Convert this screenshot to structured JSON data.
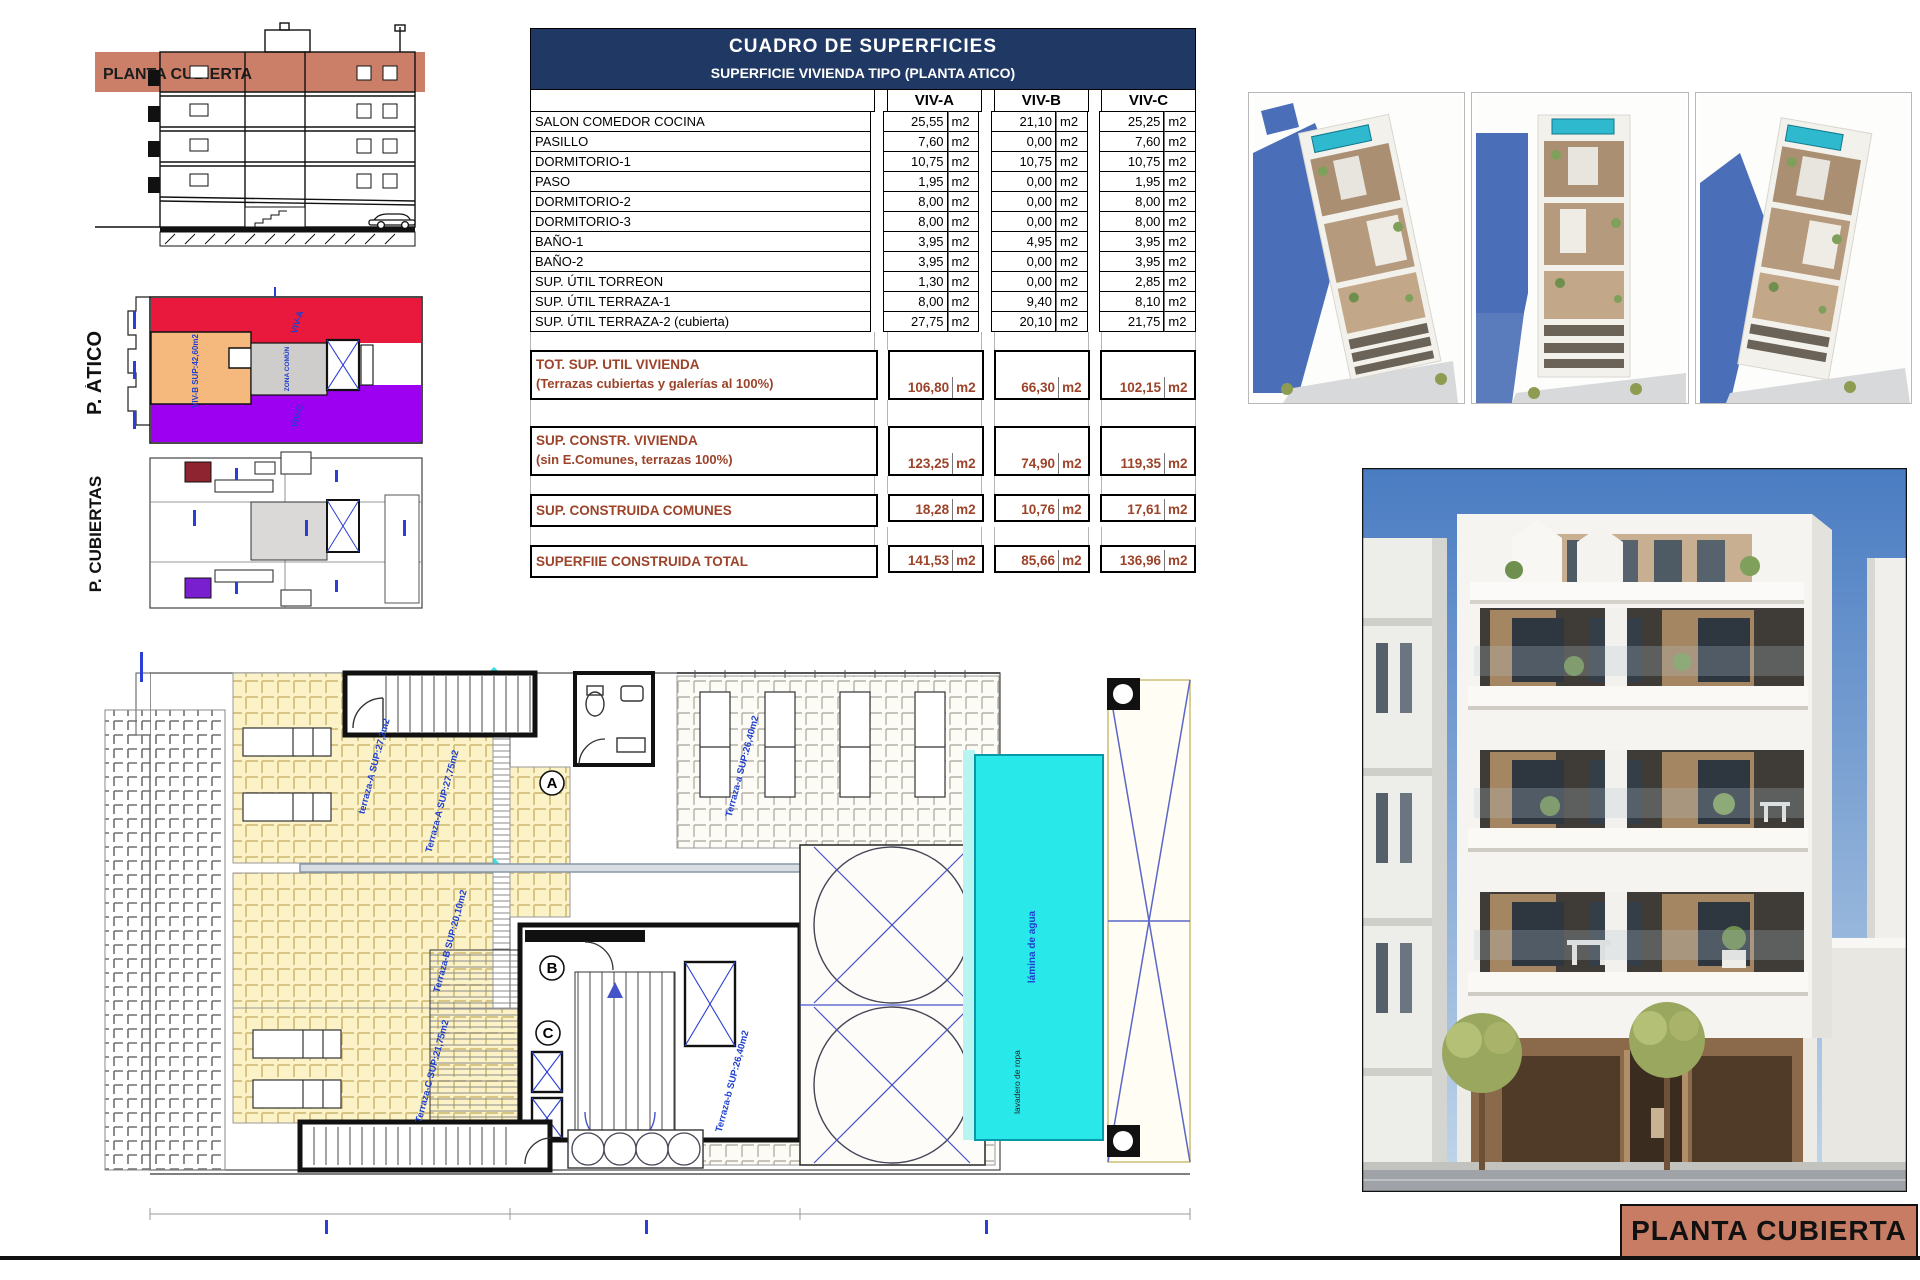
{
  "sheet": {
    "title_block": "PLANTA CUBIERTA",
    "section_band_label": "PLANTA CUBIERTA"
  },
  "table": {
    "title": "CUADRO DE SUPERFICIES",
    "subtitle": "SUPERFICIE VIVIENDA TIPO  (PLANTA ATICO)",
    "columns": [
      "VIV-A",
      "VIV-B",
      "VIV-C"
    ],
    "unit": "m2",
    "rows": [
      {
        "label": "SALON COMEDOR COCINA",
        "values": [
          "25,55",
          "21,10",
          "25,25"
        ]
      },
      {
        "label": "PASILLO",
        "values": [
          "7,60",
          "0,00",
          "7,60"
        ]
      },
      {
        "label": "DORMITORIO-1",
        "values": [
          "10,75",
          "10,75",
          "10,75"
        ]
      },
      {
        "label": "PASO",
        "values": [
          "1,95",
          "0,00",
          "1,95"
        ]
      },
      {
        "label": "DORMITORIO-2",
        "values": [
          "8,00",
          "0,00",
          "8,00"
        ]
      },
      {
        "label": "DORMITORIO-3",
        "values": [
          "8,00",
          "0,00",
          "8,00"
        ]
      },
      {
        "label": "BAÑO-1",
        "values": [
          "3,95",
          "4,95",
          "3,95"
        ]
      },
      {
        "label": "BAÑO-2",
        "values": [
          "3,95",
          "0,00",
          "3,95"
        ]
      },
      {
        "label": "SUP. ÚTIL TORREON",
        "values": [
          "1,30",
          "0,00",
          "2,85"
        ]
      },
      {
        "label": "SUP. ÚTIL TERRAZA-1",
        "values": [
          "8,00",
          "9,40",
          "8,10"
        ]
      },
      {
        "label": "SUP. ÚTIL TERRAZA-2 (cubierta)",
        "values": [
          "27,75",
          "20,10",
          "21,75"
        ]
      }
    ],
    "totals": [
      {
        "label": "TOT. SUP. UTIL VIVIENDA",
        "sublabel": "(Terrazas cubiertas y galerías al 100%)",
        "values": [
          "106,80",
          "66,30",
          "102,15"
        ]
      },
      {
        "label": "SUP. CONSTR. VIVIENDA",
        "sublabel": "(sin E.Comunes, terrazas 100%)",
        "values": [
          "123,25",
          "74,90",
          "119,35"
        ]
      },
      {
        "label": "SUP. CONSTRUIDA COMUNES",
        "sublabel": "",
        "values": [
          "18,28",
          "10,76",
          "17,61"
        ]
      },
      {
        "label": "SUPERFIIE CONSTRUIDA TOTAL",
        "sublabel": "",
        "values": [
          "141,53",
          "85,66",
          "136,96"
        ]
      }
    ]
  },
  "plans": {
    "atico": {
      "label": "P. ÁTICO",
      "zones": {
        "viv_a": "VIV-A",
        "viv_b": "VIV-B SUP:42,60m2",
        "viv_c": "VIV-C",
        "common": "ZONA COMÚN"
      }
    },
    "cubiertas": {
      "label": "P. CUBIERTAS"
    }
  },
  "roof_plan": {
    "labels": {
      "terraza_a_small": "terraza-A SUP:27,2m2",
      "terraza_a": "Terraza-A SUP:27,75m2",
      "terraza_b": "Terraza-B SUP:20,10m2",
      "terraza_c": "Terraza-C SUP:21,75m2",
      "deck_upper": "Terraza-a SUP:26,40m2",
      "deck_lower": "Terraza-b SUP:26,40m2",
      "pool": "lámina de agua",
      "laundry": "lavadero de ropa",
      "marker_a": "A",
      "marker_b": "B",
      "marker_c": "C"
    }
  },
  "colors": {
    "accent_salmon": "#c87c63",
    "table_navy": "#203864",
    "table_brown": "#9c432a",
    "pool_cyan": "#29e8ea",
    "atico_red": "#e8193c",
    "atico_orange": "#f5b97e",
    "atico_purple": "#9d00f0",
    "zone_gray": "#cfcdcb",
    "plan_label_blue": "#1e3fd0"
  }
}
